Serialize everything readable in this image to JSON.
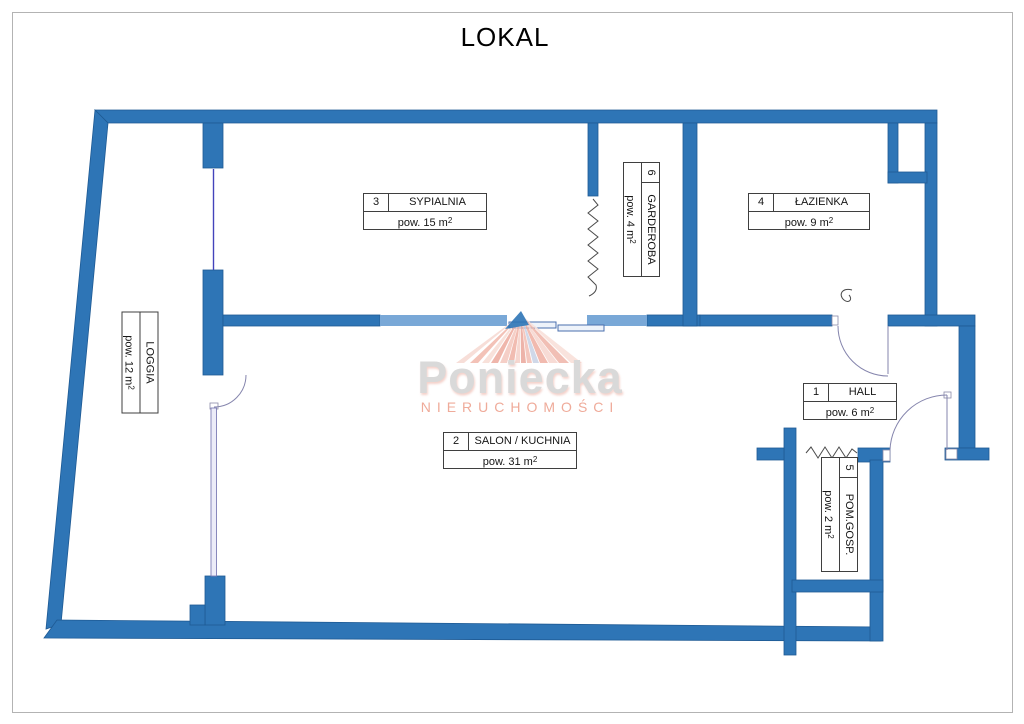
{
  "title": "LOKAL",
  "watermark": {
    "brand": "Poniecka",
    "subtitle": "NIERUCHOMOŚCI"
  },
  "rooms": {
    "hall": {
      "number": "1",
      "name": "HALL",
      "area": "pow. 6 m",
      "sup": "2"
    },
    "salon": {
      "number": "2",
      "name": "SALON / KUCHNIA",
      "area": "pow. 31 m",
      "sup": "2"
    },
    "sypialnia": {
      "number": "3",
      "name": "SYPIALNIA",
      "area": "pow. 15 m",
      "sup": "2"
    },
    "lazienka": {
      "number": "4",
      "name": "ŁAZIENKA",
      "area": "pow. 9 m",
      "sup": "2"
    },
    "pomgosp": {
      "number": "5",
      "name": "POM.GOSP.",
      "area": "pow. 2 m",
      "sup": "2"
    },
    "garderoba": {
      "number": "6",
      "name": "GARDEROBA",
      "area": "pow. 4 m",
      "sup": "2"
    },
    "loggia": {
      "name": "LOGGIA",
      "area": "pow. 12 m",
      "sup": "2"
    }
  },
  "colors": {
    "wall": "#2e75b6",
    "wall_light": "#79a8d7",
    "logo_gray": "#d9d9d9",
    "logo_salmon": "#efab9a"
  }
}
